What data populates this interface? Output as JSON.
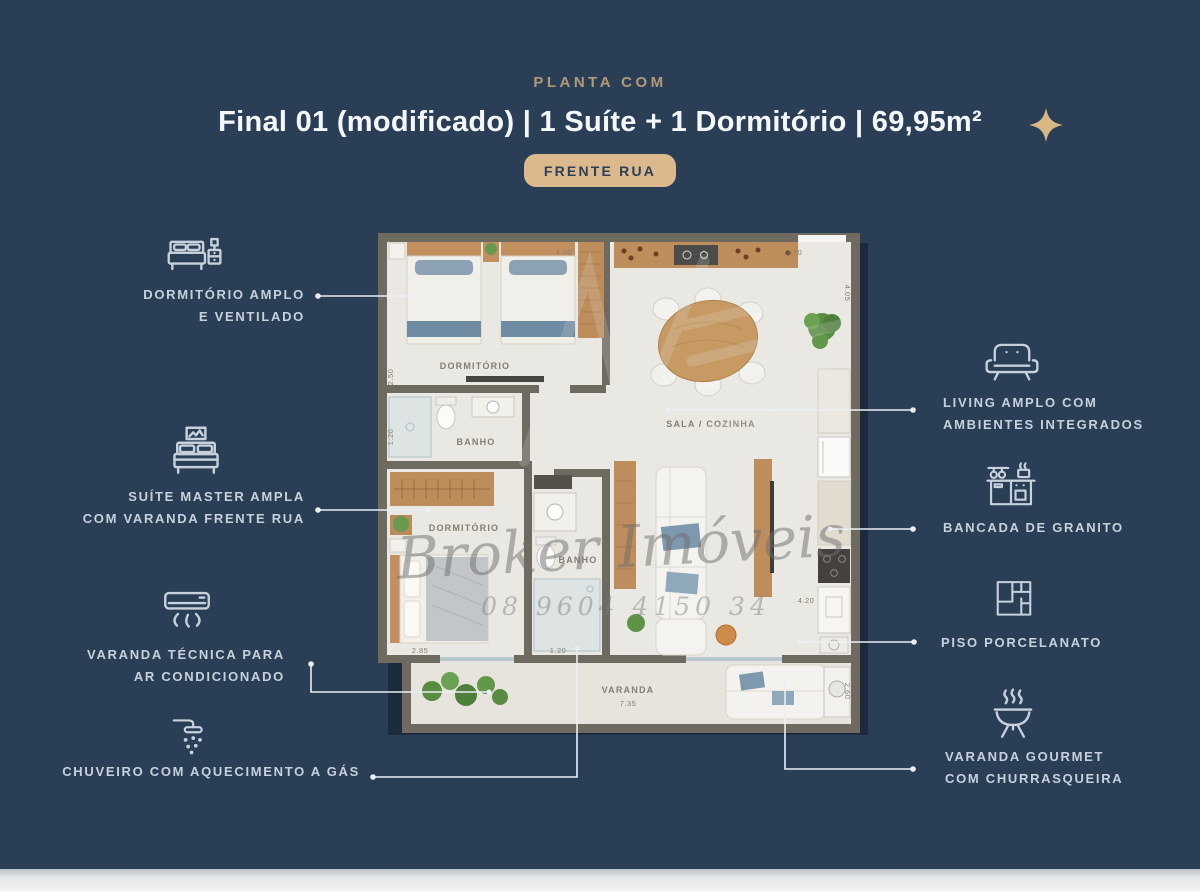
{
  "header": {
    "eyebrow": "PLANTA COM",
    "title": "Final 01 (modificado) | 1 Suíte + 1 Dormitório | 69,95m²",
    "badge": "FRENTE RUA"
  },
  "colors": {
    "background": "#2A3E56",
    "accent_gold": "#DBB98D",
    "callout_text": "#C6D1DC",
    "leader_line": "#E9EFF4",
    "plan_wall": "#6F6A60",
    "plan_floor": "#EAE8E2",
    "wood": "#BD8D5B"
  },
  "callouts_left": [
    {
      "icon": "double-bed-icon",
      "lines": [
        "DORMITÓRIO AMPLO",
        "E VENTILADO"
      ]
    },
    {
      "icon": "suite-bed-icon",
      "lines": [
        "SUÍTE MASTER AMPLA",
        "COM VARANDA FRENTE RUA"
      ]
    },
    {
      "icon": "air-conditioner-icon",
      "lines": [
        "VARANDA TÉCNICA PARA",
        "AR CONDICIONADO"
      ]
    },
    {
      "icon": "shower-icon",
      "lines": [
        "CHUVEIRO COM AQUECIMENTO A GÁS"
      ]
    }
  ],
  "callouts_right": [
    {
      "icon": "sofa-icon",
      "lines": [
        "LIVING AMPLO COM",
        "AMBIENTES INTEGRADOS"
      ]
    },
    {
      "icon": "kitchen-counter-icon",
      "lines": [
        "BANCADA DE GRANITO"
      ]
    },
    {
      "icon": "floor-tiles-icon",
      "lines": [
        "PISO PORCELANATO"
      ]
    },
    {
      "icon": "barbecue-grill-icon",
      "lines": [
        "VARANDA GOURMET",
        "COM CHURRASQUEIRA"
      ]
    }
  ],
  "floorplan": {
    "labels": {
      "dorm1": "DORMITÓRIO",
      "banho1": "BANHO",
      "suite": "DORMITÓRIO",
      "banho2": "BANHO",
      "sala": "SALA / COZINHA",
      "varanda": "VARANDA"
    },
    "dims": {
      "dorm_width": "4.00",
      "sala_width": "3.70",
      "sala_depth": "4.05",
      "dorm_depth": "2.50",
      "banho_depth": "1.20",
      "suite_width": "2.85",
      "hall_width": "1.20",
      "kitchen_depth": "4.20",
      "varanda_width": "7.35",
      "varanda_depth": "2.60"
    },
    "watermark": {
      "name": "Broker Imóveis",
      "phone": "08 9604 4150 34"
    }
  }
}
